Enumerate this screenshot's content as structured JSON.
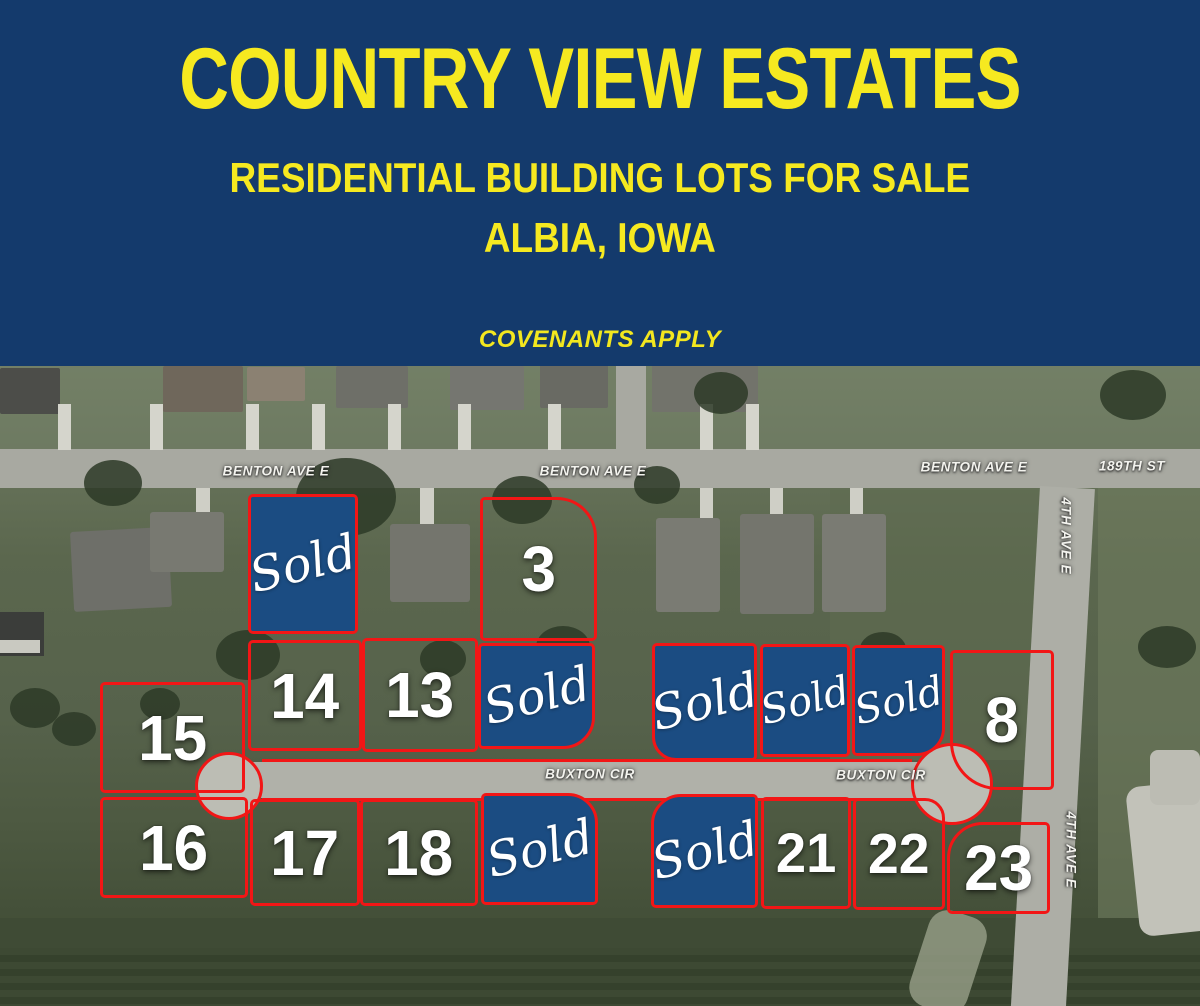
{
  "header": {
    "title": "COUNTRY VIEW ESTATES",
    "subtitle_line1": "RESIDENTIAL BUILDING LOTS FOR SALE",
    "subtitle_line2": "ALBIA, IOWA",
    "note": "COVENANTS APPLY",
    "background_color": "#143a6c",
    "text_color": "#f6e920"
  },
  "map": {
    "outline_color": "#f21616",
    "sold_fill_color": "#1b4c82",
    "street_labels": [
      {
        "text": "BENTON AVE E",
        "x": 276,
        "y": 471,
        "vertical": false
      },
      {
        "text": "BENTON AVE E",
        "x": 593,
        "y": 471,
        "vertical": false
      },
      {
        "text": "BENTON AVE E",
        "x": 974,
        "y": 467,
        "vertical": false
      },
      {
        "text": "189TH ST",
        "x": 1132,
        "y": 466,
        "vertical": false
      },
      {
        "text": "4TH AVE E",
        "x": 1066,
        "y": 536,
        "vertical": true
      },
      {
        "text": "4TH AVE E",
        "x": 1071,
        "y": 850,
        "vertical": true
      },
      {
        "text": "BUXTON CIR",
        "x": 590,
        "y": 774,
        "vertical": false
      },
      {
        "text": "BUXTON CIR",
        "x": 881,
        "y": 775,
        "vertical": false
      }
    ],
    "lots": [
      {
        "name": "lot-sold-1",
        "label": "Sold",
        "sold": true,
        "x": 248,
        "y": 494,
        "w": 110,
        "h": 140,
        "r": "5px"
      },
      {
        "name": "lot-3",
        "label": "3",
        "sold": false,
        "x": 480,
        "y": 497,
        "w": 117,
        "h": 144,
        "r": "5px 40px 5px 5px"
      },
      {
        "name": "lot-14",
        "label": "14",
        "sold": false,
        "x": 248,
        "y": 640,
        "w": 114,
        "h": 111,
        "r": "5px"
      },
      {
        "name": "lot-13",
        "label": "13",
        "sold": false,
        "x": 362,
        "y": 638,
        "w": 116,
        "h": 114,
        "r": "5px"
      },
      {
        "name": "lot-sold-2",
        "label": "Sold",
        "sold": true,
        "x": 478,
        "y": 643,
        "w": 117,
        "h": 106,
        "r": "5px 5px 32px 5px"
      },
      {
        "name": "lot-15",
        "label": "15",
        "sold": false,
        "x": 100,
        "y": 682,
        "w": 145,
        "h": 111,
        "r": "5px"
      },
      {
        "name": "lot-16",
        "label": "16",
        "sold": false,
        "x": 100,
        "y": 797,
        "w": 148,
        "h": 101,
        "r": "5px"
      },
      {
        "name": "lot-17",
        "label": "17",
        "sold": false,
        "x": 250,
        "y": 799,
        "w": 110,
        "h": 107,
        "r": "5px"
      },
      {
        "name": "lot-18",
        "label": "18",
        "sold": false,
        "x": 360,
        "y": 799,
        "w": 118,
        "h": 107,
        "r": "5px"
      },
      {
        "name": "lot-sold-3",
        "label": "Sold",
        "sold": true,
        "x": 481,
        "y": 793,
        "w": 117,
        "h": 112,
        "r": "5px 30px 5px 5px"
      },
      {
        "name": "lot-sold-4",
        "label": "Sold",
        "sold": true,
        "x": 652,
        "y": 643,
        "w": 105,
        "h": 118,
        "r": "5px 5px 5px 24px"
      },
      {
        "name": "lot-sold-5",
        "label": "Sold",
        "sold": true,
        "x": 760,
        "y": 644,
        "w": 90,
        "h": 113,
        "r": "5px"
      },
      {
        "name": "lot-sold-6",
        "label": "Sold",
        "sold": true,
        "x": 852,
        "y": 645,
        "w": 93,
        "h": 111,
        "r": "5px 5px 28px 5px"
      },
      {
        "name": "lot-8",
        "label": "8",
        "sold": false,
        "x": 950,
        "y": 650,
        "w": 104,
        "h": 140,
        "r": "5px 5px 5px 48px"
      },
      {
        "name": "lot-sold-7",
        "label": "Sold",
        "sold": true,
        "x": 651,
        "y": 794,
        "w": 107,
        "h": 114,
        "r": "30px 5px 5px 5px"
      },
      {
        "name": "lot-21",
        "label": "21",
        "sold": false,
        "x": 761,
        "y": 797,
        "w": 90,
        "h": 112,
        "r": "5px"
      },
      {
        "name": "lot-22",
        "label": "22",
        "sold": false,
        "x": 853,
        "y": 798,
        "w": 92,
        "h": 112,
        "r": "5px 20px 5px 5px"
      },
      {
        "name": "lot-23",
        "label": "23",
        "sold": false,
        "x": 947,
        "y": 822,
        "w": 103,
        "h": 92,
        "r": "36px 5px 5px 5px"
      }
    ]
  }
}
